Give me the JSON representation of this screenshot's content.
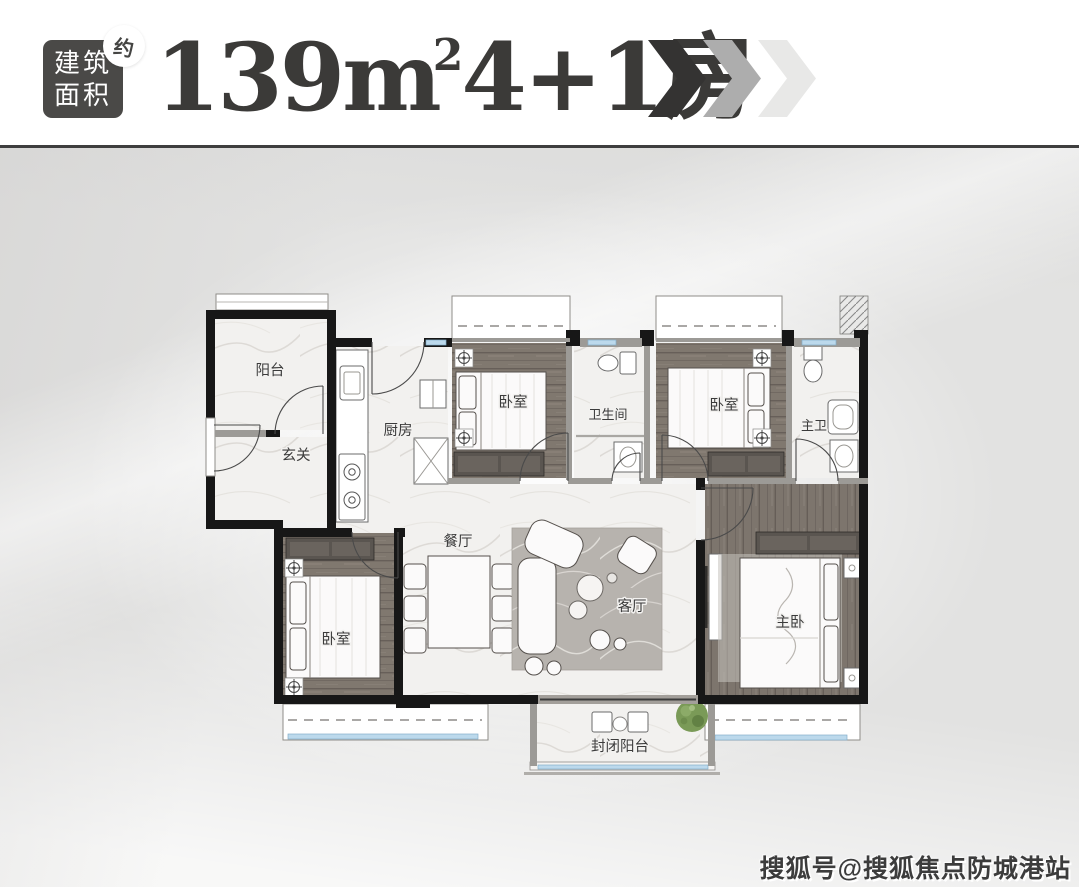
{
  "header": {
    "area_badge": {
      "line1": "建筑",
      "line2": "面积",
      "approx_label": "约"
    },
    "title": {
      "full": "139m²4+1房",
      "number": "139m",
      "superscript": "2",
      "suffix": "4+1房"
    },
    "chevron_colors": [
      "#343332",
      "#adadad",
      "#e8e8e7"
    ]
  },
  "floorplan": {
    "rooms": [
      {
        "label": "阳台"
      },
      {
        "label": "玄关"
      },
      {
        "label": "厨房"
      },
      {
        "label": "卧室"
      },
      {
        "label": "卫生间"
      },
      {
        "label": "卧室"
      },
      {
        "label": "主卫"
      },
      {
        "label": "餐厅"
      },
      {
        "label": "客厅"
      },
      {
        "label": "卧室"
      },
      {
        "label": "主卧"
      },
      {
        "label": "封闭阳台"
      }
    ],
    "colors": {
      "wall": "#171717",
      "wood_floor": "#80786f",
      "marble_floor": "#f2f1ef",
      "window_glass": "#bcd9ec",
      "rug": "#b7b3ae",
      "plant": "#7a9a57"
    }
  },
  "watermark": {
    "text": "搜狐号@搜狐焦点防城港站"
  }
}
